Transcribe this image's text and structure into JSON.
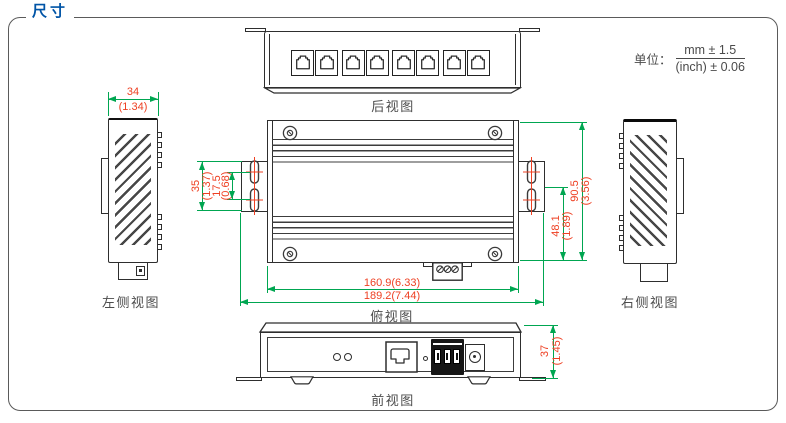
{
  "title": "尺寸",
  "unit_note": {
    "label": "单位：",
    "mm_tolerance": "mm ± 1.5",
    "inch_tolerance": "(inch) ± 0.06"
  },
  "colors": {
    "accent_blue": "#0054a6",
    "dimension_line_green": "#00a651",
    "dimension_text_red": "#ee4023",
    "drawing_line": "#2e2e2e",
    "label_gray": "#4c4c4c"
  },
  "views": {
    "rear": {
      "label": "后视图",
      "port_count": 8
    },
    "left_side": {
      "label": "左侧视图",
      "width_mm": "34",
      "width_inch": "(1.34)"
    },
    "top": {
      "label": "俯视图",
      "ear_height_mm": "35",
      "ear_height_inch": "(1.37)",
      "slot_pitch_mm": "17.5",
      "slot_pitch_inch": "(0.68)",
      "mount_to_edge_mm": "48.1",
      "mount_to_edge_inch": "(1.89)",
      "depth_mm": "90.5",
      "depth_inch": "(3.56)",
      "body_width": "160.9(6.33)",
      "total_width": "189.2(7.44)"
    },
    "right_side": {
      "label": "右侧视图"
    },
    "front": {
      "label": "前视图",
      "height_mm": "37",
      "height_inch": "(1.45)"
    }
  }
}
